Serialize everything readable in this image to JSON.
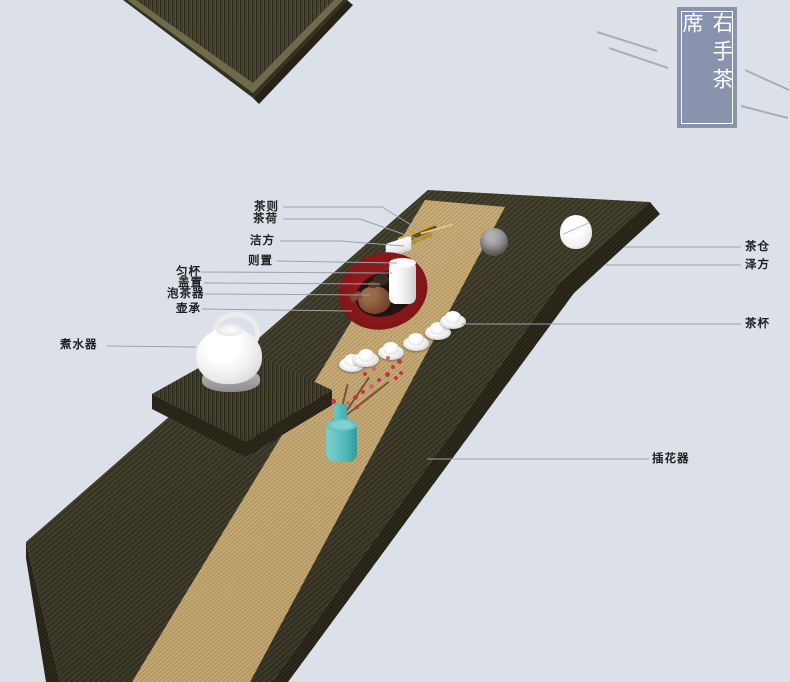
{
  "title": {
    "text": "右手茶席"
  },
  "labels": {
    "cha_ze": "茶则",
    "cha_he": "茶荷",
    "jie_fang": "洁方",
    "ze_zhi": "则置",
    "yun_bei": "匀杯",
    "gai_zhi": "盖置",
    "pao_cha_qi": "泡茶器",
    "hu_cheng": "壶承",
    "zhu_shui_qi": "煮水器",
    "cha_cang": "茶仓",
    "ze_fang": "泽方",
    "cha_bei": "茶杯",
    "cha_hua_qi": "插花器"
  },
  "colors": {
    "background": "#DCE0E9",
    "wood_dark": "#43402C",
    "runner_tan": "#C8AC79",
    "title_box": "#8A93AE",
    "tray_red": "#7E1618",
    "vase_teal": "#54BDBD",
    "label_text": "#1F1F1F",
    "leader_line": "#9AA2AE"
  }
}
